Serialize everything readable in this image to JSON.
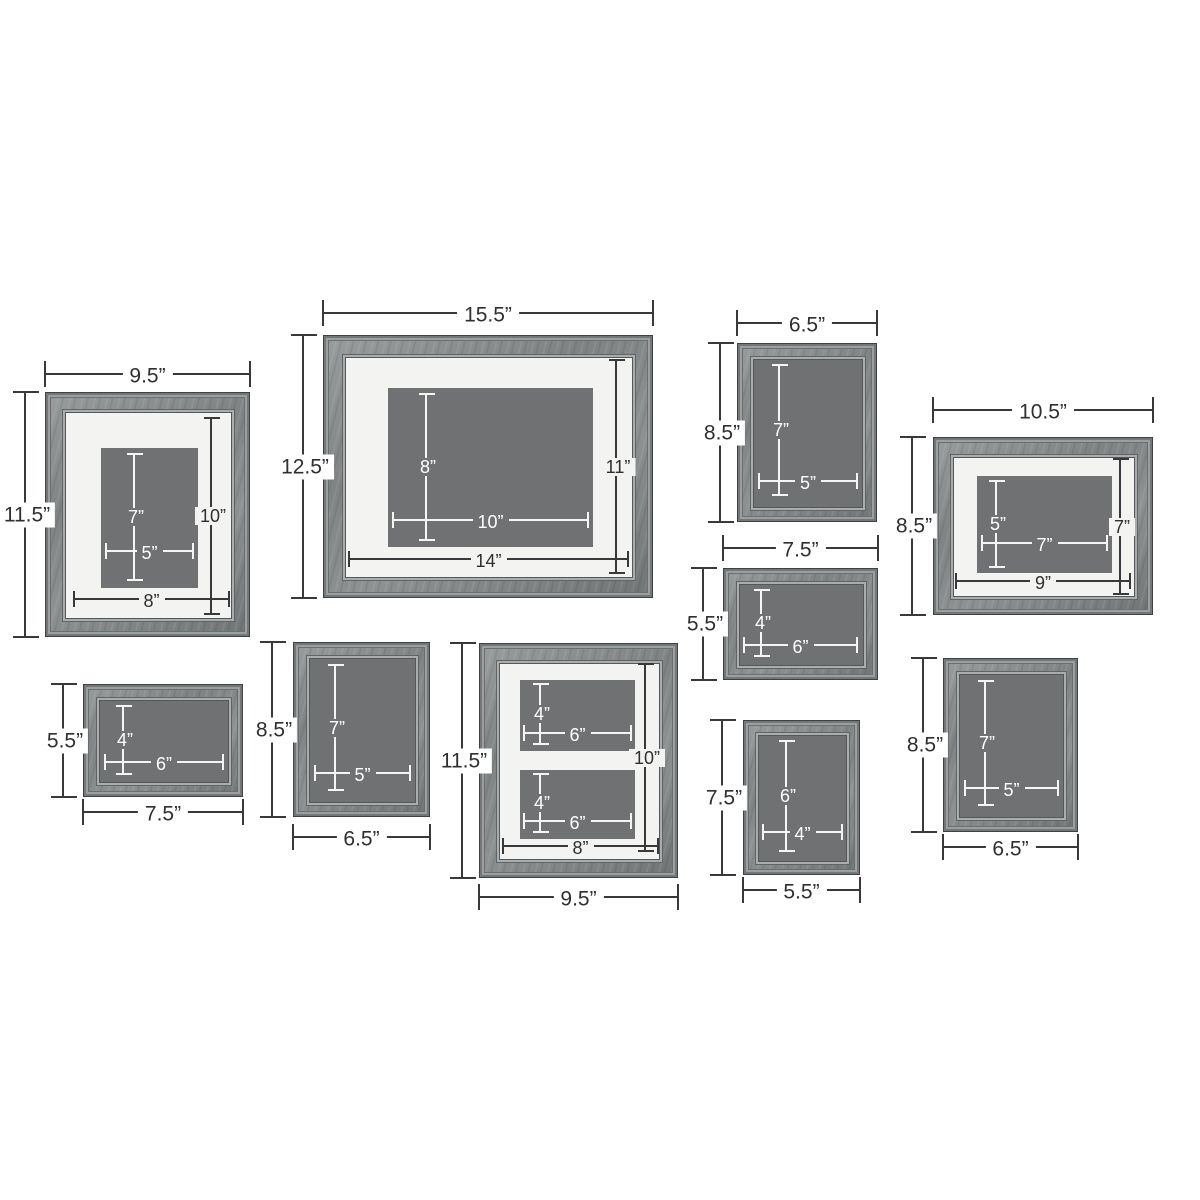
{
  "colors": {
    "background": "#ffffff",
    "wood": "#8b8e8f",
    "mat": "#f3f3f1",
    "photo_placeholder": "#6f7172",
    "dimension_line_dark": "#39393b",
    "dimension_line_light": "#f5f5f5"
  },
  "frames": [
    {
      "id": "9.5x11.5-matted-top-left",
      "width_label": "9.5”",
      "height_label": "11.5”",
      "photo_height_label": "7”",
      "photo_width_label": "5”",
      "opening_width_label": "8”",
      "opening_height_label": "10”"
    },
    {
      "id": "15.5x12.5-matted-top-center",
      "width_label": "15.5”",
      "height_label": "12.5”",
      "photo_height_label": "8”",
      "photo_width_label": "10”",
      "opening_width_label": "14”",
      "opening_height_label": "11”"
    },
    {
      "id": "6.5x8.5-top-right",
      "width_label": "6.5”",
      "height_label": "8.5”",
      "photo_height_label": "7”",
      "photo_width_label": "5”"
    },
    {
      "id": "10.5x8.5-matted-far-right",
      "width_label": "10.5”",
      "height_label": "8.5”",
      "photo_height_label": "5”",
      "photo_width_label": "7”",
      "opening_width_label": "9”",
      "opening_height_label": "7”"
    },
    {
      "id": "7.5x5.5-middle-right",
      "width_label": "7.5”",
      "height_label": "5.5”",
      "photo_height_label": "4”",
      "photo_width_label": "6”"
    },
    {
      "id": "7.5x5.5-bottom-left",
      "width_label": "7.5”",
      "height_label": "5.5”",
      "photo_height_label": "4”",
      "photo_width_label": "6”"
    },
    {
      "id": "6.5x8.5-bottom-second",
      "width_label": "6.5”",
      "height_label": "8.5”",
      "photo_height_label": "7”",
      "photo_width_label": "5”"
    },
    {
      "id": "9.5x11.5-collage-bottom-center",
      "width_label": "9.5”",
      "height_label": "11.5”",
      "opening_width_label": "8”",
      "opening_height_label": "10”",
      "photos": [
        {
          "height_label": "4”",
          "width_label": "6”"
        },
        {
          "height_label": "4”",
          "width_label": "6”"
        }
      ]
    },
    {
      "id": "5.5x7.5-bottom",
      "width_label": "5.5”",
      "height_label": "7.5”",
      "photo_height_label": "6”",
      "photo_width_label": "4”"
    },
    {
      "id": "6.5x8.5-bottom-right",
      "width_label": "6.5”",
      "height_label": "8.5”",
      "photo_height_label": "7”",
      "photo_width_label": "5”"
    }
  ]
}
